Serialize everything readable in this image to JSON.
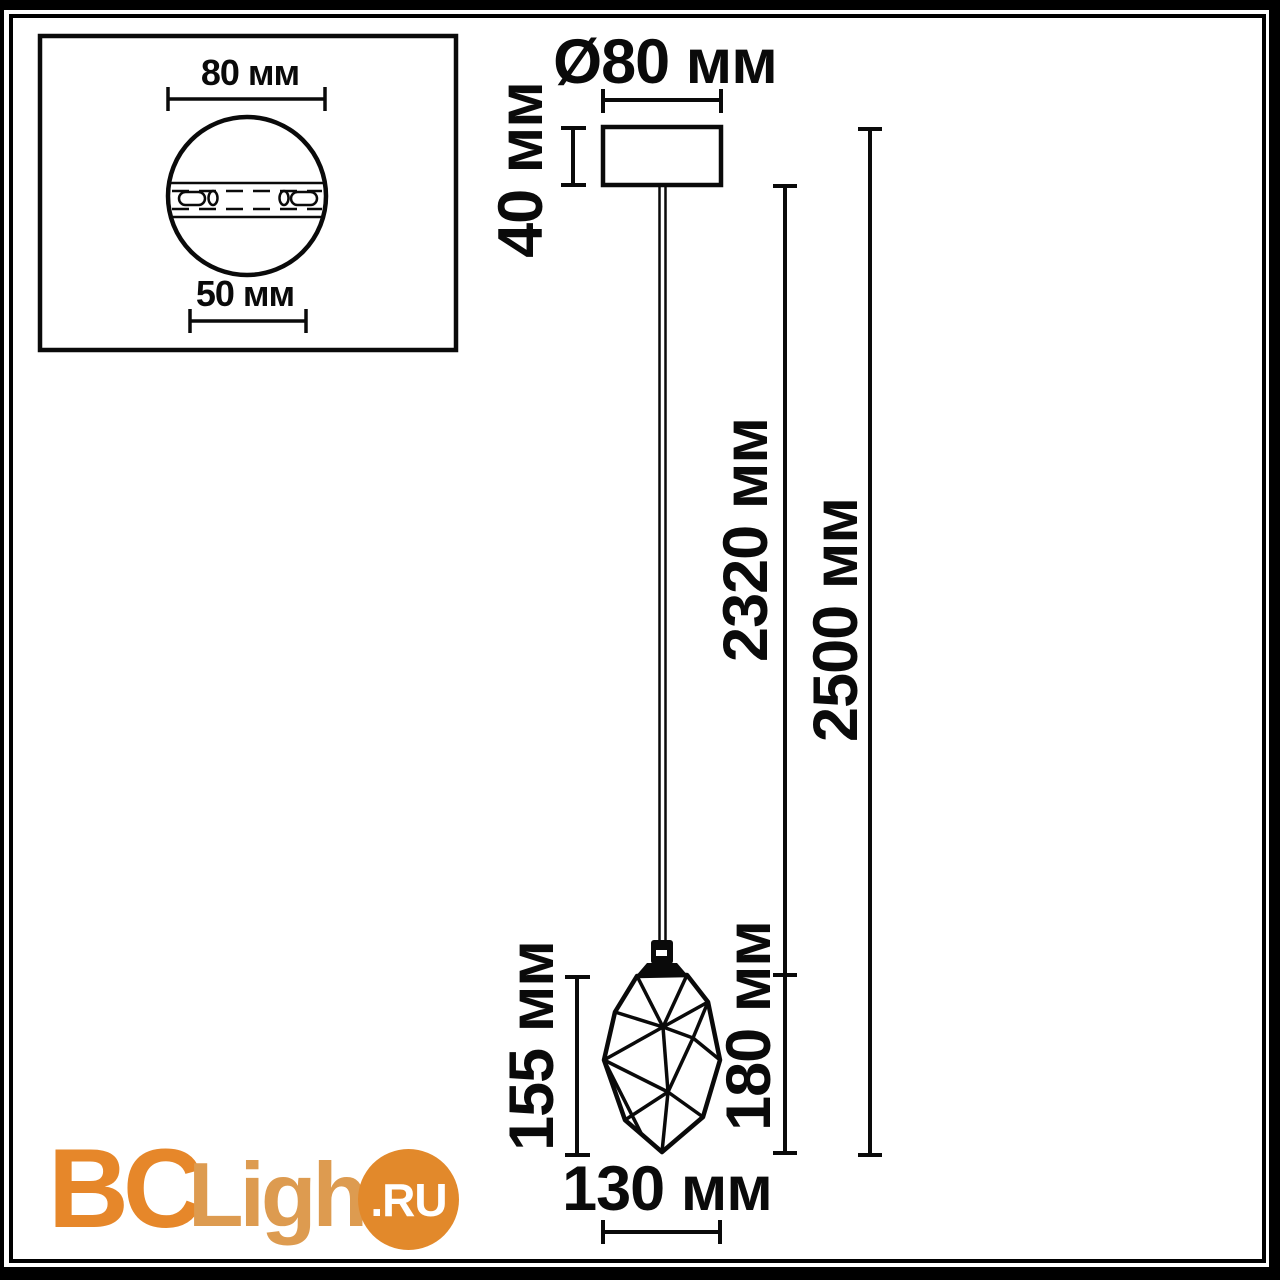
{
  "mount_detail": {
    "plate_diameter_label": "80 мм",
    "bracket_width_label": "50 мм"
  },
  "dimensions": {
    "canopy_diameter": "Ø80 мм",
    "canopy_height": "40 мм",
    "cord_length": "2320 мм",
    "overall_height": "2500 мм",
    "shade_height": "155 мм",
    "shade_drop": "180 мм",
    "shade_width": "130 мм"
  },
  "watermark": {
    "brand_prefix": "BC",
    "brand_middle": "Light",
    "brand_suffix": ".RU"
  },
  "colors": {
    "line": "#0a0a0a",
    "logo_prefix": "#e6872a",
    "logo_middle": "#dd9b50",
    "logo_circle_bg": "#e2892b",
    "logo_suffix_text": "#ffffff"
  }
}
